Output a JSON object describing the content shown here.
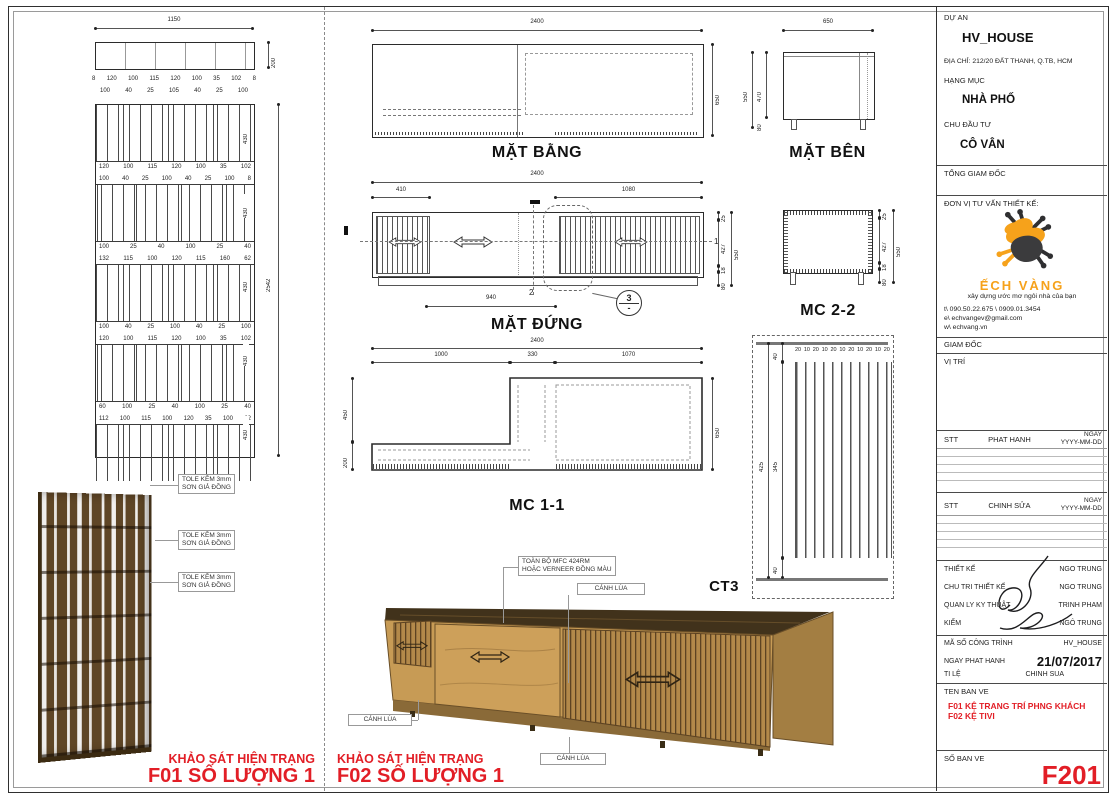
{
  "colors": {
    "red": "#e21e26",
    "orange": "#f6a21b",
    "wood_light": "#c79b55",
    "wood_dark": "#41321b"
  },
  "f01": {
    "dim_total_w": "1150",
    "dim_plan_h": "200",
    "dim_row_a": [
      "8",
      "120",
      "100",
      "115",
      "120",
      "100",
      "35",
      "102",
      "8"
    ],
    "dim_row_b": [
      "100",
      "40",
      "25",
      "105",
      "40",
      "25",
      "100"
    ],
    "band_h": "430",
    "elev_total_h": "2542",
    "elev_rows": [
      [
        "120",
        "100",
        "115",
        "120",
        "100",
        "35",
        "102"
      ],
      [
        "100",
        "40",
        "25",
        "100",
        "40",
        "25",
        "100",
        "8"
      ],
      [
        "100",
        "25",
        "40",
        "100",
        "25",
        "40"
      ],
      [
        "132",
        "115",
        "100",
        "120",
        "115",
        "160",
        "62"
      ],
      [
        "100",
        "40",
        "25",
        "100",
        "40",
        "25",
        "100"
      ],
      [
        "120",
        "100",
        "115",
        "120",
        "100",
        "35",
        "102"
      ],
      [
        "60",
        "100",
        "25",
        "40",
        "100",
        "25",
        "40"
      ],
      [
        "112",
        "100",
        "115",
        "100",
        "120",
        "35",
        "100",
        "62"
      ]
    ],
    "tole1": "TOLE KẼM 3mm",
    "tole2": "SƠN GIẢ ĐỒNG",
    "survey": "KHẢO SÁT HIỆN TRẠNG",
    "qty": "F01 SỐ LƯỢNG 1"
  },
  "f02": {
    "plan": {
      "title": "MẶT BẰNG",
      "w": "2400",
      "h": "650"
    },
    "side": {
      "title": "MẶT BÊN",
      "w": "650",
      "h_total": "550",
      "h_body": "470",
      "h_leg": "80"
    },
    "front": {
      "title": "MẶT ĐỨNG",
      "w": "2400",
      "d_left": "410",
      "d_right": "1080",
      "d_bottom": "940",
      "r1": "25",
      "r2": "427",
      "r3": "18",
      "r4": "80",
      "rt": "550",
      "axis1": "1",
      "axis2": "2",
      "detail_no": "3",
      "detail_sheet": "-"
    },
    "mc11": {
      "title": "MC 1-1",
      "w": "2400",
      "t1": "1000",
      "t2": "330",
      "t3": "1070",
      "l1": "450",
      "l2": "200",
      "r": "650"
    },
    "mc22": {
      "title": "MC 2-2",
      "r1": "25",
      "r2": "427",
      "r3": "18",
      "r4": "80",
      "rt": "550"
    },
    "ct3": {
      "title": "CT3",
      "top_row": [
        "20",
        "10",
        "20",
        "10",
        "20",
        "10",
        "20",
        "10",
        "20",
        "10",
        "20"
      ],
      "l_top": "40",
      "l_mid": "345",
      "l_bot": "40",
      "l_total": "425"
    },
    "notes": {
      "mfc1": "TOÀN BỘ MFC 424RM",
      "mfc2": "HOẶC VERNEER ĐỒNG MÀU",
      "sliding": "CÁNH LÙA"
    },
    "survey": "KHẢO SÁT HIỆN TRẠNG",
    "qty": "F02 SỐ LƯỢNG 1"
  },
  "titleblock": {
    "project_label": "DỰ AN",
    "project_name": "HV_HOUSE",
    "address": "ĐỊA CHỈ: 212/20 ĐẤT THANH, Q.TB, HCM",
    "category_label": "HẠNG MỤC",
    "category": "NHÀ PHỐ",
    "client_label": "CHU ĐẦU TƯ",
    "client": "CÔ VÂN",
    "gd_label": "TỔNG GIAM ĐỐC",
    "consultant_label": "ĐƠN VỊ TƯ VẤN THIẾT KẾ:",
    "brand": "ẾCH VÀNG",
    "slogan": "xây dựng ước mơ ngôi nhà của bạn",
    "phone": "t\\ 090.50.22.675 \\ 0909.01.3454",
    "email": "e\\ echvangev@gmail.com",
    "website": "w\\ echvang.vn",
    "director_label": "GIAM ĐỐC",
    "location_label": "VỊ TRÍ",
    "stt": "STT",
    "issue_label": "PHAT HANH",
    "edit_label": "CHINH SỬA",
    "date_label_1": "NGAY",
    "date_label_2": "YYYY-MM-DD",
    "personnel": [
      {
        "label": "THIẾT KẾ",
        "value": "NGO TRUNG"
      },
      {
        "label": "CHU TRI THIẾT KẾ",
        "value": "NGO TRUNG"
      },
      {
        "label": "QUAN LY KY THUẬT",
        "value": "TRINH PHAM"
      },
      {
        "label": "KIỂM",
        "value": "NGÔ TRUNG"
      }
    ],
    "meta": [
      {
        "label": "MÃ SỐ CÔNG TRÌNH",
        "value": "HV_HOUSE"
      },
      {
        "label": "NGAY PHAT HANH",
        "value": "21/07/2017"
      },
      {
        "label": "TI LỆ",
        "value": "CHINH SUA"
      }
    ],
    "drawing_name_label": "TEN BAN VE",
    "drawing_names": [
      "F01 KỆ TRANG TRÍ PHNG KHÁCH",
      "F02 KỆ TIVI"
    ],
    "sheet_no_label": "SỐ BAN VE",
    "sheet_no": "F201"
  }
}
